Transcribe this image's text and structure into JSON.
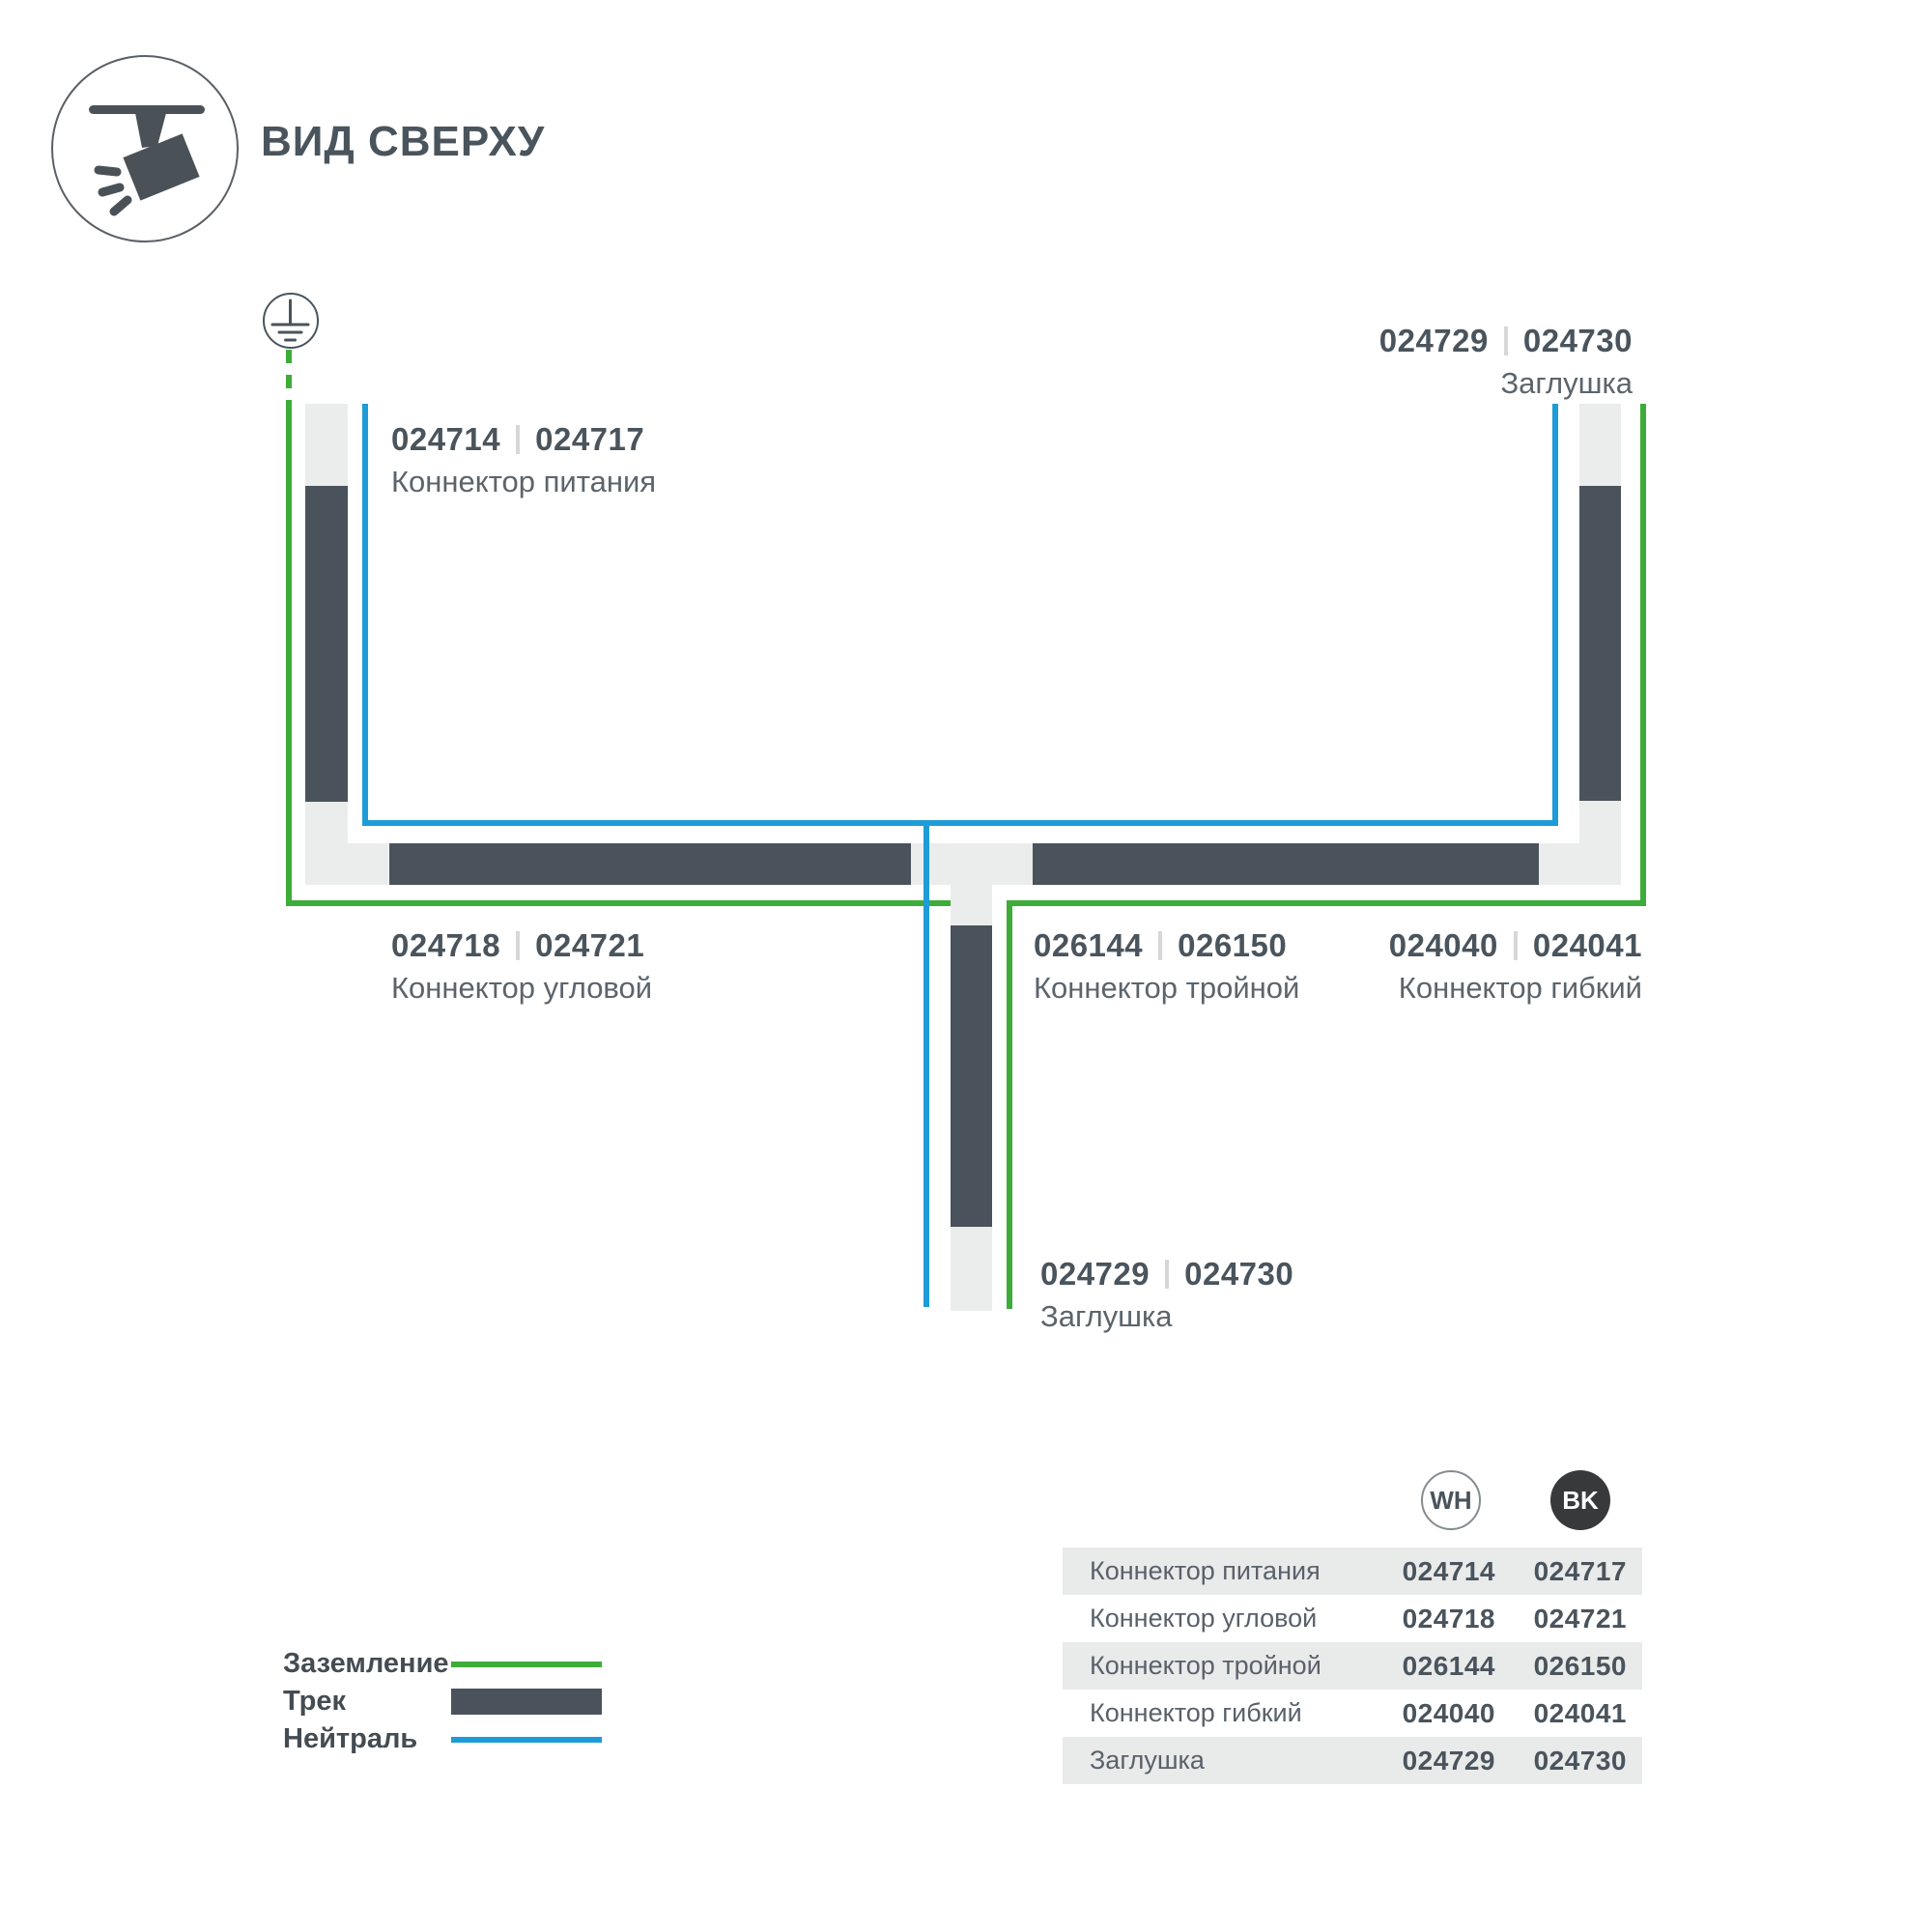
{
  "header": {
    "title": "ВИД СВЕРХУ"
  },
  "colors": {
    "ground_green": "#3EAC38",
    "neutral_blue": "#1E9CD8",
    "track_dark": "#4A525B",
    "track_light": "#EBECEC",
    "text_primary": "#4A545C",
    "text_secondary": "#5C646B",
    "row_bg": "#E9EAEA",
    "bk_circle": "#37393B"
  },
  "diagram": {
    "labels": {
      "power": {
        "code_wh": "024714",
        "code_bk": "024717",
        "name": "Коннектор питания"
      },
      "endcap_top": {
        "code_wh": "024729",
        "code_bk": "024730",
        "name": "Заглушка"
      },
      "corner": {
        "code_wh": "024718",
        "code_bk": "024721",
        "name": "Коннектор угловой"
      },
      "triple": {
        "code_wh": "026144",
        "code_bk": "026150",
        "name": "Коннектор тройной"
      },
      "flex": {
        "code_wh": "024040",
        "code_bk": "024041",
        "name": "Коннектор гибкий"
      },
      "endcap_bottom": {
        "code_wh": "024729",
        "code_bk": "024730",
        "name": "Заглушка"
      }
    }
  },
  "legend": {
    "items": [
      {
        "label": "Заземление",
        "swatch": "green-line"
      },
      {
        "label": "Трек",
        "swatch": "track-bar"
      },
      {
        "label": "Нейтраль",
        "swatch": "blue-line"
      }
    ]
  },
  "table": {
    "columns": [
      {
        "id": "wh",
        "label": "WH"
      },
      {
        "id": "bk",
        "label": "BK"
      }
    ],
    "rows": [
      {
        "name": "Коннектор питания",
        "wh": "024714",
        "bk": "024717"
      },
      {
        "name": "Коннектор угловой",
        "wh": "024718",
        "bk": "024721"
      },
      {
        "name": "Коннектор тройной",
        "wh": "026144",
        "bk": "026150"
      },
      {
        "name": "Коннектор гибкий",
        "wh": "024040",
        "bk": "024041"
      },
      {
        "name": "Заглушка",
        "wh": "024729",
        "bk": "024730"
      }
    ]
  }
}
